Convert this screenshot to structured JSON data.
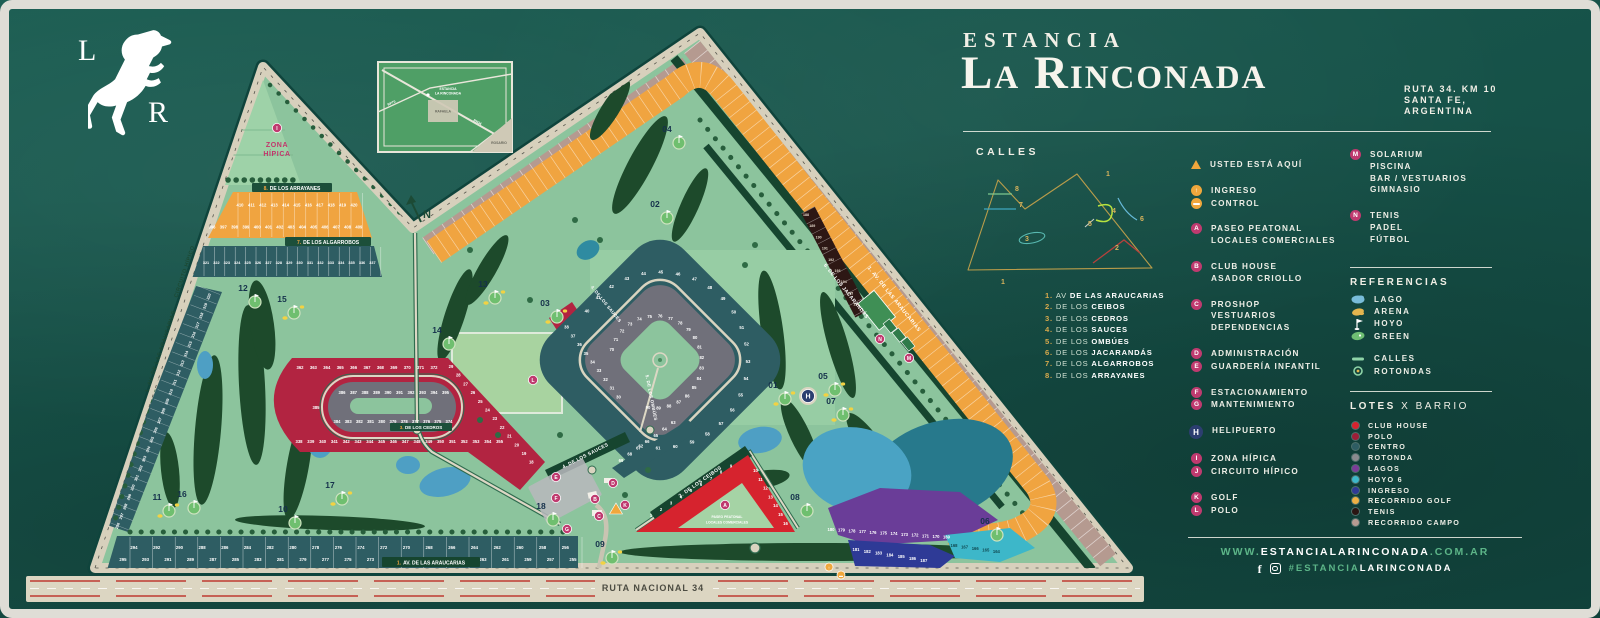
{
  "brand": {
    "monogram_top": "L",
    "monogram_bottom": "R"
  },
  "header": {
    "pretitle": "ESTANCIA",
    "title": "La Rinconada",
    "address_lines": [
      "RUTA 34. KM 10",
      "SANTA FE,",
      "ARGENTINA"
    ]
  },
  "calles": {
    "heading": "CALLES",
    "streets": [
      {
        "num": "1.",
        "prefix": "AV",
        "name": "DE LAS ARAUCARIAS"
      },
      {
        "num": "2.",
        "prefix": "DE LOS",
        "name": "CEIBOS"
      },
      {
        "num": "3.",
        "prefix": "DE LOS",
        "name": "CEDROS"
      },
      {
        "num": "4.",
        "prefix": "DE LOS",
        "name": "SAUCES"
      },
      {
        "num": "5.",
        "prefix": "DE LOS",
        "name": "OMBÚES"
      },
      {
        "num": "6.",
        "prefix": "DE LOS",
        "name": "JACARANDÁS"
      },
      {
        "num": "7.",
        "prefix": "DE LOS",
        "name": "ALGARROBOS"
      },
      {
        "num": "8.",
        "prefix": "DE LOS",
        "name": "ARRAYANES"
      }
    ]
  },
  "diagram_numbers": [
    "1",
    "2",
    "3",
    "4",
    "5",
    "6",
    "7",
    "8"
  ],
  "legend_groups": [
    [
      {
        "marker": "▲",
        "style": "tri",
        "lines": [
          "USTED ESTÁ AQUÍ"
        ]
      }
    ],
    [
      {
        "marker": "↑",
        "style": "orange",
        "lines": [
          "INGRESO"
        ]
      },
      {
        "marker": "▬",
        "style": "orange",
        "lines": [
          "CONTROL"
        ]
      }
    ],
    [
      {
        "marker": "A",
        "style": "pink",
        "lines": [
          "PASEO PEATONAL",
          "LOCALES COMERCIALES"
        ]
      }
    ],
    [
      {
        "marker": "B",
        "style": "pink",
        "lines": [
          "CLUB HOUSE",
          "ASADOR CRIOLLO"
        ]
      }
    ],
    [
      {
        "marker": "C",
        "style": "pink",
        "lines": [
          "PROSHOP",
          "VESTUARIOS",
          "DEPENDENCIAS"
        ]
      }
    ],
    [
      {
        "marker": "D",
        "style": "pink",
        "lines": [
          "ADMINISTRACIÓN"
        ]
      },
      {
        "marker": "E",
        "style": "pink",
        "lines": [
          "GUARDERÍA INFANTIL"
        ]
      }
    ],
    [
      {
        "marker": "F",
        "style": "pink",
        "lines": [
          "ESTACIONAMIENTO"
        ]
      },
      {
        "marker": "G",
        "style": "pink",
        "lines": [
          "MANTENIMIENTO"
        ]
      }
    ],
    [
      {
        "marker": "H",
        "style": "navy",
        "lines": [
          "HELIPUERTO"
        ]
      }
    ],
    [
      {
        "marker": "I",
        "style": "pink",
        "lines": [
          "ZONA HÍPICA"
        ]
      },
      {
        "marker": "J",
        "style": "pink",
        "lines": [
          "CIRCUITO HÍPICO"
        ]
      }
    ],
    [
      {
        "marker": "K",
        "style": "pink",
        "lines": [
          "GOLF"
        ]
      },
      {
        "marker": "L",
        "style": "pink",
        "lines": [
          "POLO"
        ]
      }
    ]
  ],
  "facilities": [
    {
      "marker": "M",
      "lines": [
        "SOLARIUM",
        "PISCINA",
        "BAR / VESTUARIOS",
        "GIMNASIO"
      ]
    },
    {
      "marker": "N",
      "lines": [
        "TENIS",
        "PADEL",
        "FÚTBOL"
      ]
    }
  ],
  "referencias": {
    "heading": "REFERENCIAS",
    "groups": [
      [
        {
          "icon": "lago",
          "label": "LAGO"
        },
        {
          "icon": "arena",
          "label": "ARENA"
        },
        {
          "icon": "hoyo",
          "label": "HOYO"
        },
        {
          "icon": "green",
          "label": "GREEN"
        }
      ],
      [
        {
          "icon": "calles",
          "label": "CALLES"
        },
        {
          "icon": "rotondas",
          "label": "ROTONDAS"
        }
      ]
    ]
  },
  "lotes": {
    "heading_bold": "LOTES",
    "heading_rest": " X BARRIO",
    "items": [
      {
        "color": "#d8232f",
        "label": "CLUB HOUSE"
      },
      {
        "color": "#9e1f38",
        "label": "POLO"
      },
      {
        "color": "#2e5d63",
        "label": "CENTRO"
      },
      {
        "color": "#8a8a8e",
        "label": "ROTONDA"
      },
      {
        "color": "#7b3d98",
        "label": "LAGOS"
      },
      {
        "color": "#3db7c9",
        "label": "HOYO 6"
      },
      {
        "color": "#303a96",
        "label": "INGRESO"
      },
      {
        "color": "#eeb045",
        "label": "RECORRIDO GOLF"
      },
      {
        "color": "#2a1512",
        "label": "TENIS"
      },
      {
        "color": "#b79b92",
        "label": "RECORRIDO CAMPO"
      }
    ]
  },
  "footer": {
    "website_pre": "WWW.",
    "website_main": "ESTANCIALARINCONADA",
    "website_suffix": ".COM.AR",
    "hashtag_pre": "#",
    "hashtag_green": "ESTANCIA",
    "hashtag_white": "LARINCONADA"
  },
  "map": {
    "labels": {
      "zona1": "ZONA",
      "zona2": "HÍPICA",
      "circuito": "CIRCUITO HÍPICO",
      "araucarias_left": "1. AV. DE LAS ARAUCARIAS",
      "araucarias_bottom_num": "1.",
      "araucarias_bottom": "AV. DE LAS ARAUCARIAS",
      "araucarias_right": "1. AV. DE LAS ARAUCARIAS",
      "arrayanes_num": "8.",
      "arrayanes": "DE LOS ARRAYANES",
      "algarrobos_num": "7.",
      "algarrobos": "DE LOS ALGARROBOS",
      "cedros_num": "3.",
      "cedros": "DE LOS CEDROS",
      "sauces_low": "4. DE LOS SAUCES",
      "sauces_in": "4. DE LOS SAUCES",
      "ombues": "5. DE LOS OMBÚES",
      "ceibos": "2. DE LOS CEIBOS",
      "jacarandas": "6. DE LOS JACARANDÁS",
      "paseo1": "PASEO PEATONAL",
      "paseo2": "LOCALES COMERCIALES",
      "ruta": "RUTA NACIONAL 34",
      "north": "N"
    },
    "inset": {
      "line1": "ESTANCIA",
      "line2": "LA RINCONADA",
      "rafaela": "RAFAELA",
      "rosario": "ROSARIO",
      "rn34": "RN34",
      "rp70": "RP70"
    },
    "holes": [
      "01",
      "02",
      "03",
      "04",
      "05",
      "06",
      "07",
      "08",
      "09",
      "10",
      "11",
      "12",
      "13",
      "14",
      "15",
      "16",
      "17",
      "18"
    ],
    "markers": [
      "A",
      "B",
      "C",
      "D",
      "E",
      "F",
      "G",
      "H",
      "I",
      "J",
      "K",
      "L",
      "M",
      "N"
    ],
    "lot_ranges": {
      "club_house": [
        1,
        16
      ],
      "polo_arm": [
        18,
        29
      ],
      "centro_red": [
        30,
        39
      ],
      "centro_ring": [
        40,
        62
      ],
      "entrance_band": [
        63,
        69
      ],
      "centro_inner": [
        70,
        90
      ],
      "recorrido_golf": [
        110,
        163
      ],
      "hoyo6_lots": [
        164,
        168
      ],
      "lagos_lots": [
        169,
        180
      ],
      "ingreso_lots": [
        181,
        187
      ],
      "tenis_lots": [
        188,
        196
      ],
      "recorrido_campo": [
        198,
        253
      ],
      "bottom_row": [
        255,
        295
      ],
      "left_edge": [
        296,
        320
      ],
      "algarrobos_row": [
        321,
        337
      ],
      "polo_outer": [
        338,
        372
      ],
      "rotonda_inner": [
        374,
        395
      ],
      "arrayanes_block": [
        396,
        420
      ]
    }
  }
}
